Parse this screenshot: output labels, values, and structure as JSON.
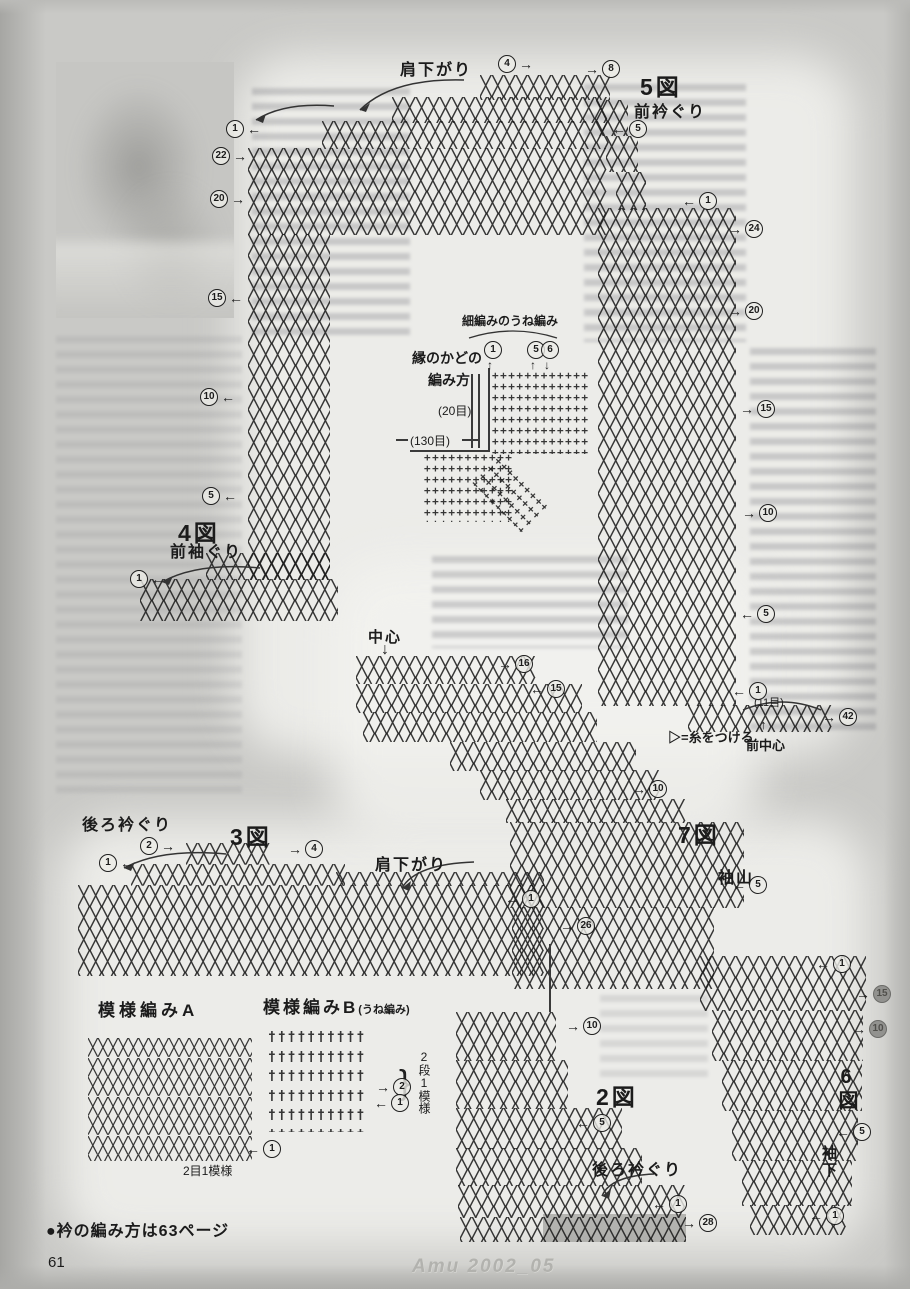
{
  "symbols": {
    "cross_stitch": "╳",
    "single_crochet": "+",
    "ridge_stitch": "†",
    "arrow_up": "↑",
    "arrow_down": "↓",
    "brace": "}"
  },
  "figures": {
    "fig5": {
      "title": "5図",
      "front_neck": "前衿ぐり",
      "shoulder": "肩下がり"
    },
    "fig4": {
      "title": "4図",
      "front_armhole": "前袖ぐり"
    },
    "fig3": {
      "title": "3図",
      "back_neck": "後ろ衿ぐり",
      "shoulder": "肩下がり"
    },
    "fig7": {
      "title": "7図",
      "sleeve_cap": "袖山",
      "center": "中心"
    },
    "fig2": {
      "title": "2図",
      "back_neck": "後ろ衿ぐり"
    },
    "fig6": {
      "title": "6図",
      "sleeve_underarm": "袖下"
    },
    "pattern_a": {
      "title": "模様編みA",
      "repeat": "2目1模様"
    },
    "pattern_b": {
      "title": "模様編みB",
      "subtitle": "(うね編み)",
      "repeat": "2段1模様"
    },
    "edge_corner": {
      "title_line1": "縁のかどの",
      "title_line2": "編み方",
      "ridge_label": "細編みのうね編み",
      "stitches_20": "(20目)",
      "stitches_130": "(130目)"
    },
    "notes": {
      "stitches_11": "(11目)",
      "attach_yarn": "▷=糸をつける",
      "front_center": "前中心"
    }
  },
  "footer": {
    "note": "●衿の編み方は63ページ",
    "page_number": "61",
    "magazine": "Amu 2002_05"
  },
  "callouts": [
    {
      "x": 498,
      "y": 55,
      "n": "4",
      "arrow": "→",
      "side": "after"
    },
    {
      "x": 585,
      "y": 60,
      "n": "8",
      "arrow": "→",
      "side": "before"
    },
    {
      "x": 226,
      "y": 120,
      "n": "1",
      "arrow": "←",
      "side": "after"
    },
    {
      "x": 612,
      "y": 120,
      "n": "5",
      "arrow": "←",
      "side": "before"
    },
    {
      "x": 212,
      "y": 147,
      "n": "22",
      "arrow": "→",
      "side": "after"
    },
    {
      "x": 210,
      "y": 190,
      "n": "20",
      "arrow": "→",
      "side": "after"
    },
    {
      "x": 682,
      "y": 192,
      "n": "1",
      "arrow": "←",
      "side": "before"
    },
    {
      "x": 728,
      "y": 220,
      "n": "24",
      "arrow": "→",
      "side": "before"
    },
    {
      "x": 208,
      "y": 289,
      "n": "15",
      "arrow": "←",
      "side": "after"
    },
    {
      "x": 728,
      "y": 302,
      "n": "20",
      "arrow": "→",
      "side": "before"
    },
    {
      "x": 200,
      "y": 388,
      "n": "10",
      "arrow": "←",
      "side": "after"
    },
    {
      "x": 740,
      "y": 400,
      "n": "15",
      "arrow": "→",
      "side": "before"
    },
    {
      "x": 202,
      "y": 487,
      "n": "5",
      "arrow": "←",
      "side": "after"
    },
    {
      "x": 742,
      "y": 504,
      "n": "10",
      "arrow": "→",
      "side": "before"
    },
    {
      "x": 740,
      "y": 605,
      "n": "5",
      "arrow": "←",
      "side": "before"
    },
    {
      "x": 732,
      "y": 682,
      "n": "1",
      "arrow": "←",
      "side": "before"
    },
    {
      "x": 822,
      "y": 708,
      "n": "42",
      "arrow": "→",
      "side": "before"
    },
    {
      "x": 130,
      "y": 570,
      "n": "1",
      "arrow": "←",
      "side": "after"
    },
    {
      "x": 498,
      "y": 655,
      "n": "16",
      "arrow": "→",
      "side": "before"
    },
    {
      "x": 530,
      "y": 680,
      "n": "15",
      "arrow": "←",
      "side": "before"
    },
    {
      "x": 632,
      "y": 780,
      "n": "10",
      "arrow": "→",
      "side": "before"
    },
    {
      "x": 732,
      "y": 876,
      "n": "5",
      "arrow": "←",
      "side": "before"
    },
    {
      "x": 140,
      "y": 837,
      "n": "2",
      "arrow": "→",
      "side": "after"
    },
    {
      "x": 288,
      "y": 840,
      "n": "4",
      "arrow": "→",
      "side": "before"
    },
    {
      "x": 99,
      "y": 854,
      "n": "1",
      "arrow": "←",
      "side": "after"
    },
    {
      "x": 505,
      "y": 890,
      "n": "1",
      "arrow": "←",
      "side": "before"
    },
    {
      "x": 560,
      "y": 917,
      "n": "26",
      "arrow": "→",
      "side": "before"
    },
    {
      "x": 376,
      "y": 1078,
      "n": "2",
      "arrow": "→",
      "side": "before"
    },
    {
      "x": 374,
      "y": 1094,
      "n": "1",
      "arrow": "←",
      "side": "before"
    },
    {
      "x": 246,
      "y": 1140,
      "n": "1",
      "arrow": "←",
      "side": "before"
    },
    {
      "x": 566,
      "y": 1017,
      "n": "10",
      "arrow": "→",
      "side": "before"
    },
    {
      "x": 576,
      "y": 1114,
      "n": "5",
      "arrow": "←",
      "side": "before"
    },
    {
      "x": 652,
      "y": 1195,
      "n": "1",
      "arrow": "←",
      "side": "before"
    },
    {
      "x": 682,
      "y": 1214,
      "n": "28",
      "arrow": "→",
      "side": "before"
    },
    {
      "x": 816,
      "y": 955,
      "n": "1",
      "arrow": "←",
      "side": "before"
    },
    {
      "x": 856,
      "y": 985,
      "n": "15",
      "arrow": "→",
      "side": "before",
      "dark": true
    },
    {
      "x": 852,
      "y": 1020,
      "n": "10",
      "arrow": "→",
      "side": "before",
      "dark": true
    },
    {
      "x": 836,
      "y": 1123,
      "n": "5",
      "arrow": "←",
      "side": "before"
    },
    {
      "x": 809,
      "y": 1207,
      "n": "1",
      "arrow": "←",
      "side": "before"
    },
    {
      "x": 484,
      "y": 341,
      "n": "1"
    },
    {
      "x": 527,
      "y": 341,
      "n": "5"
    },
    {
      "x": 541,
      "y": 341,
      "n": "6"
    }
  ]
}
